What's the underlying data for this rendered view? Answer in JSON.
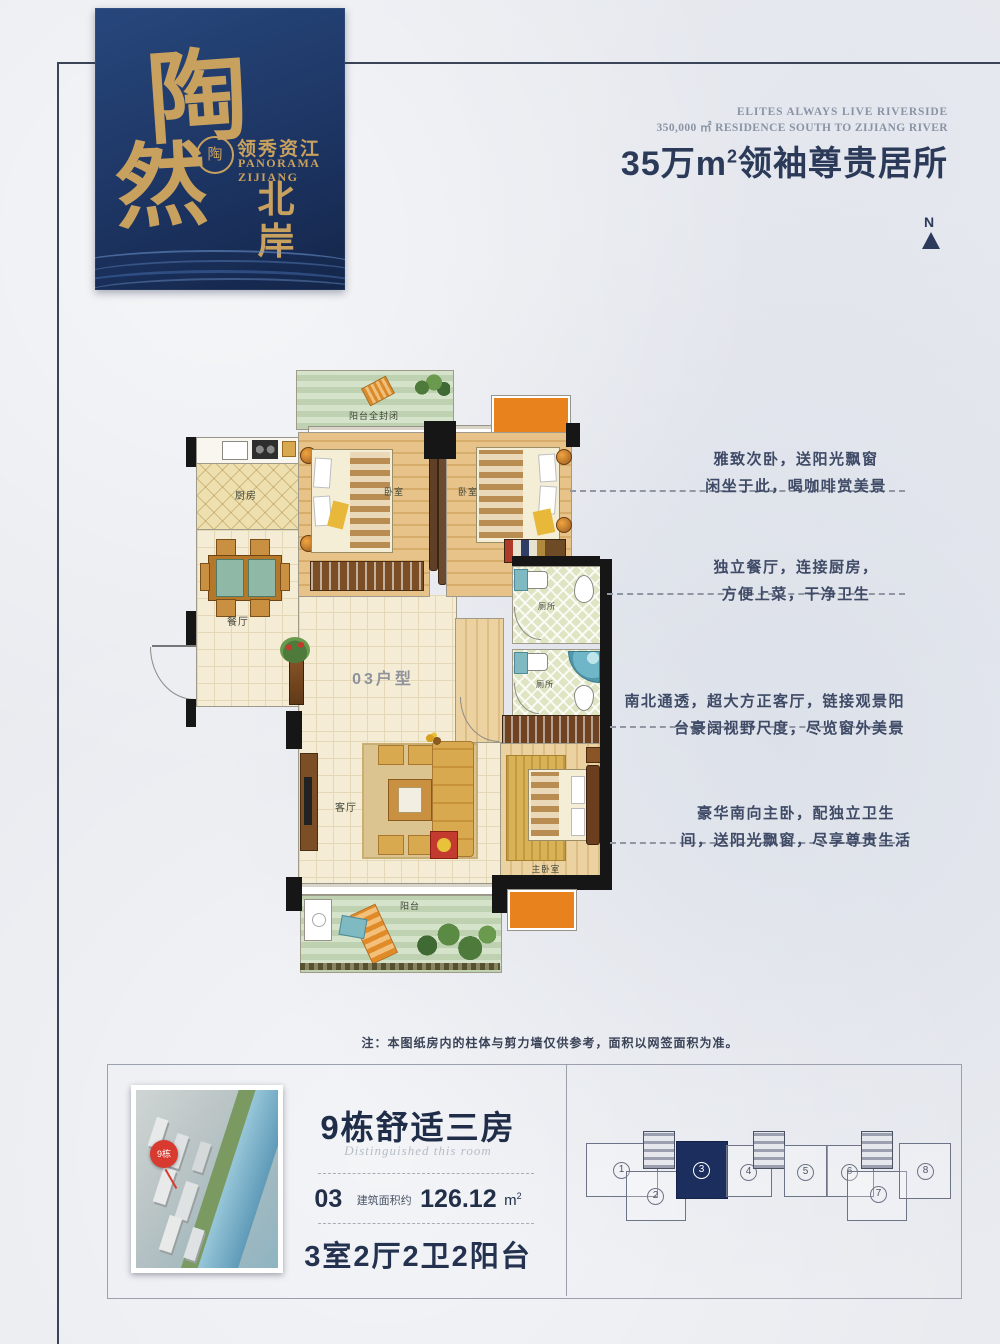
{
  "page": {
    "background": "#e9ebf0",
    "frame_color": "#3c4557"
  },
  "logo": {
    "char1": "陶",
    "char2": "然",
    "vertical_name_top": "北",
    "vertical_name_bottom": "岸",
    "brand_cn": "领秀资江",
    "brand_en_line1": "PANORAMA",
    "brand_en_line2": "ZIJIANG",
    "seal_char": "陶",
    "card_color": "#1d3563",
    "gold": "#c9a15e"
  },
  "header": {
    "en_line1": "ELITES ALWAYS LIVE RIVERSIDE",
    "en_line2": "350,000 ㎡ RESIDENCE SOUTH TO ZIJIANG RIVER",
    "headline_main": "35万m",
    "headline_sup": "2",
    "headline_rest": "领袖尊贵居所",
    "north_label": "N"
  },
  "floorplan": {
    "unit_type_label": "03户型",
    "accent_orange": "#e8821c",
    "rooms": {
      "balcony_top": "阳台全封闭",
      "kitchen": "厨房",
      "bedroom1": "卧室",
      "bedroom2": "卧室",
      "dining": "餐厅",
      "living": "客厅",
      "bath1": "厕所",
      "bath2": "厕所",
      "master": "主卧室",
      "balcony_bottom": "阳台"
    }
  },
  "annotations": [
    {
      "line1": "雅致次卧，送阳光飘窗",
      "line2": "闲坐于此，喝咖啡赏美景"
    },
    {
      "line1": "独立餐厅，连接厨房，",
      "line2": "方便上菜，干净卫生"
    },
    {
      "line1": "南北通透，超大方正客厅，链接观景阳",
      "line2": "台豪阔视野尺度，尽览窗外美景"
    },
    {
      "line1": "豪华南向主卧，配独立卫生",
      "line2": "间，送阳光飘窗，尽享尊贵生活"
    }
  ],
  "note": "注：本图纸房内的柱体与剪力墙仅供参考，面积以网签面积为准。",
  "footer": {
    "title": "9栋舒适三房",
    "script_text": "Distinguished this room",
    "unit_no": "03",
    "area_label": "建筑面积约",
    "area_value": "126.12",
    "area_unit": "m",
    "area_unit_sup": "2",
    "layout_text": "3室2厅2卫2阳台",
    "pin_label": "9栋",
    "pin_color": "#d93a2f",
    "keyplan": {
      "units": [
        "1",
        "2",
        "3",
        "4",
        "5",
        "6",
        "7",
        "8"
      ],
      "highlight_unit": "3",
      "highlight_color": "#1c2e5e"
    }
  }
}
